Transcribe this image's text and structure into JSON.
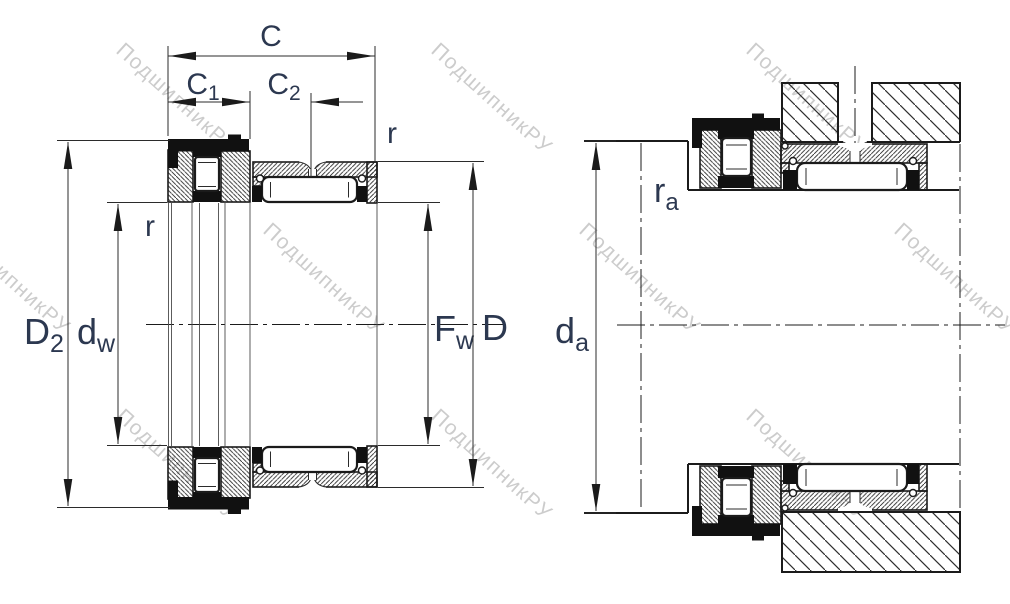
{
  "drawing": {
    "type": "bearing cross-section technical drawing",
    "left_view_dimensions": [
      "C",
      "C1",
      "C2",
      "r",
      "D2",
      "dw",
      "Fw",
      "D"
    ],
    "right_view_dimensions": [
      "da",
      "ra"
    ]
  },
  "labels": {
    "c": "C",
    "c1": {
      "main": "C",
      "sub": "1"
    },
    "c2": {
      "main": "C",
      "sub": "2"
    },
    "r_inner": "r",
    "r_outer": "r",
    "d2": {
      "main": "D",
      "sub": "2"
    },
    "dw": {
      "main": "d",
      "sub": "w"
    },
    "fw": {
      "main": "F",
      "sub": "w"
    },
    "d_outer": "D",
    "da": {
      "main": "d",
      "sub": "a"
    },
    "ra": {
      "main": "r",
      "sub": "a"
    }
  },
  "watermark": {
    "text": "ПодшипникРУ"
  },
  "colors": {
    "line": "#1b1b1b",
    "label": "#2c3850",
    "watermark": "#9a9a9a",
    "background": "#ffffff"
  }
}
